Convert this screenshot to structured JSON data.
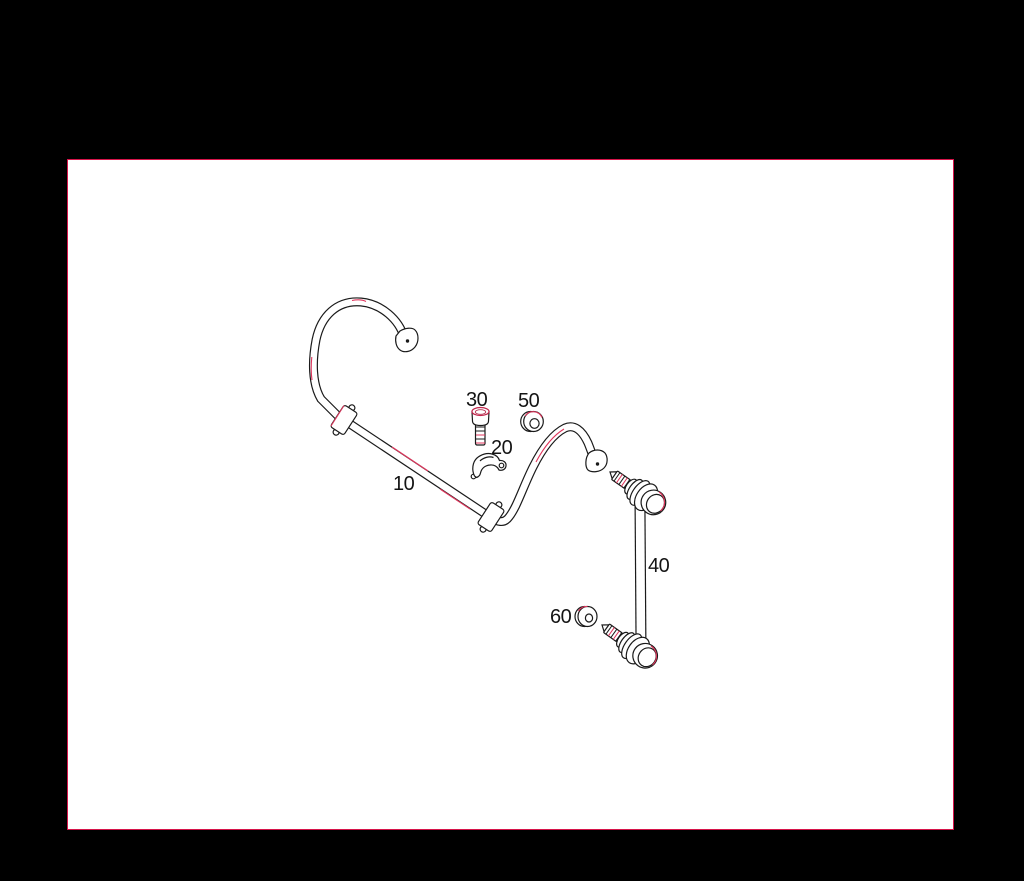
{
  "page": {
    "background_color": "#000000",
    "frame_background": "#ffffff",
    "frame_border_outer_color": "#000000",
    "frame_border_inner_color": "#d6144a",
    "line_ink_color": "#1a1a1a",
    "line_accent_color": "#e0355c"
  },
  "diagram": {
    "type": "exploded-parts-line-drawing",
    "callouts": {
      "c10": {
        "label": "10"
      },
      "c20": {
        "label": "20"
      },
      "c30": {
        "label": "30"
      },
      "c40": {
        "label": "40"
      },
      "c50": {
        "label": "50"
      },
      "c60": {
        "label": "60"
      }
    }
  }
}
